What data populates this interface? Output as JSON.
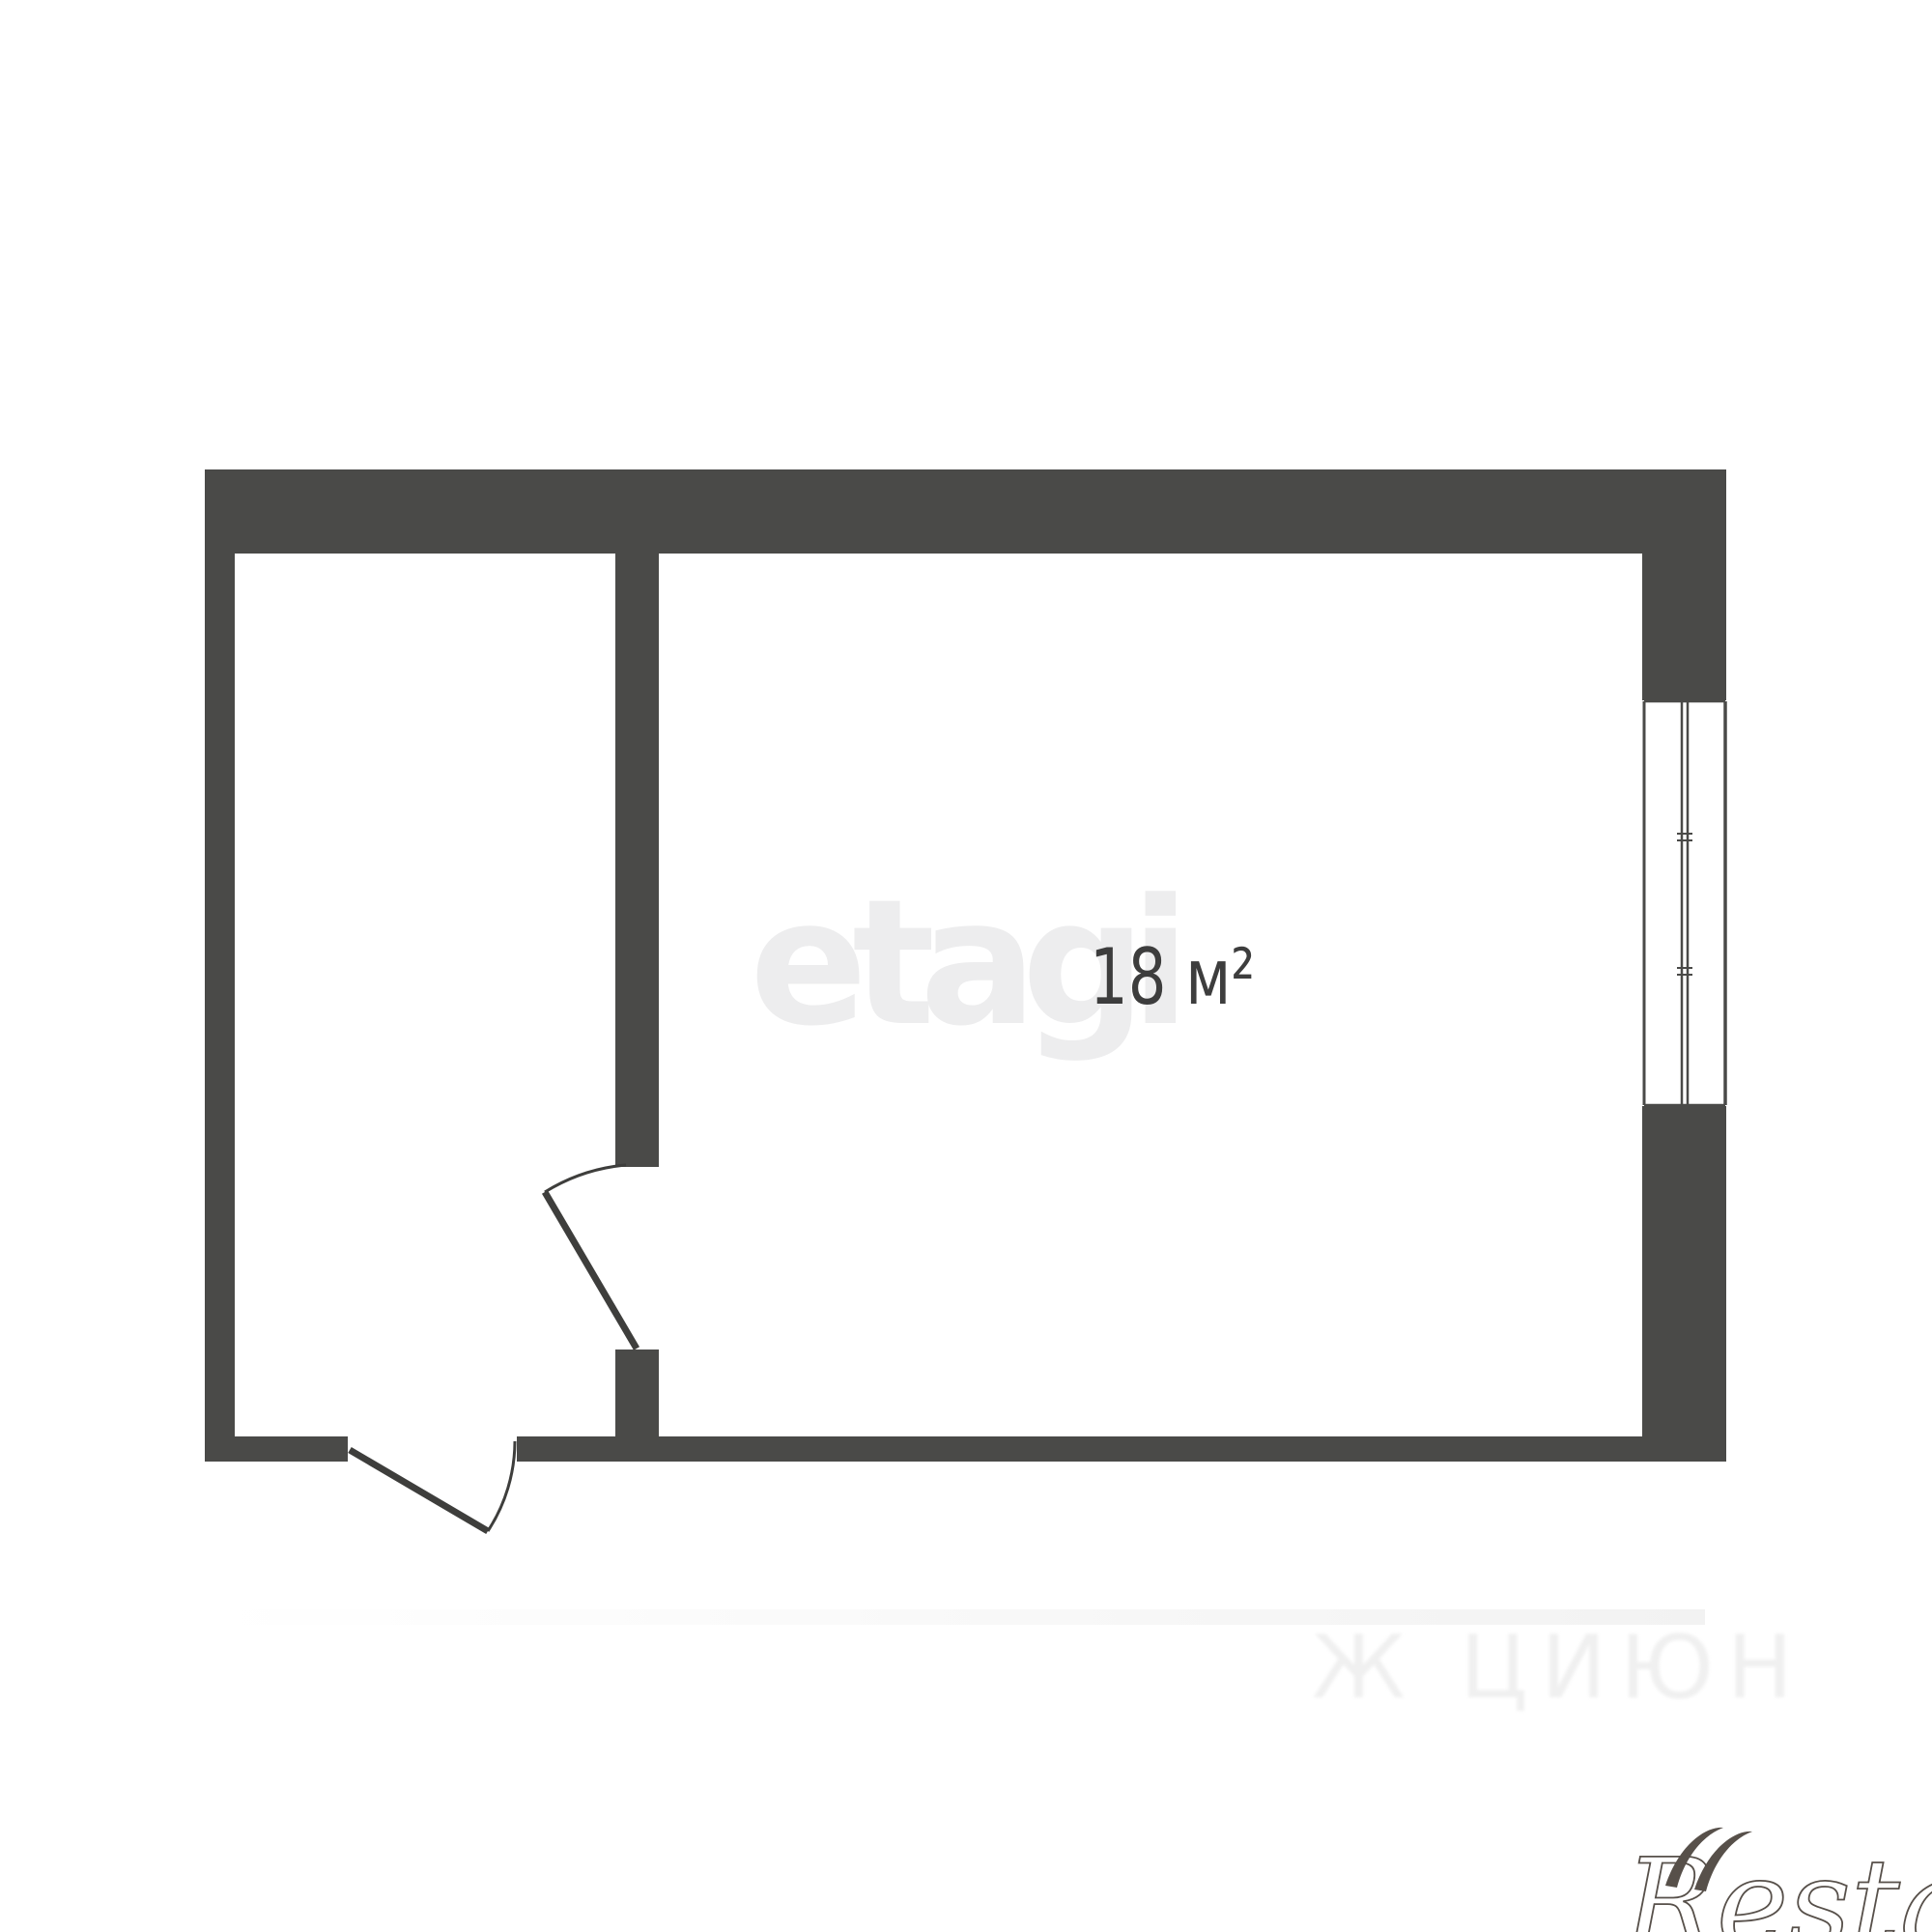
{
  "plan": {
    "type": "floor-plan",
    "rooms": [
      {
        "name": "main-room",
        "area_label": "18 м²"
      },
      {
        "name": "hallway",
        "area_label": ""
      }
    ],
    "features": [
      "entry-door-bottom",
      "interior-door-partition",
      "window-right-wall"
    ]
  },
  "labels": {
    "area": "18 м²"
  },
  "watermarks": {
    "center": "etagi",
    "bottom_right": "Restate",
    "bottom_faint": "Ж ЦИЮН"
  },
  "colors": {
    "background": "#ffffff",
    "wall": "#4a4a48",
    "door_line": "#3e3e3c",
    "window_line": "#4a4a48",
    "area_text": "#3d3d3d",
    "etagi_watermark": "#ededee",
    "restate_logo": "#57504a",
    "faint_text": "#f0f0f0"
  }
}
